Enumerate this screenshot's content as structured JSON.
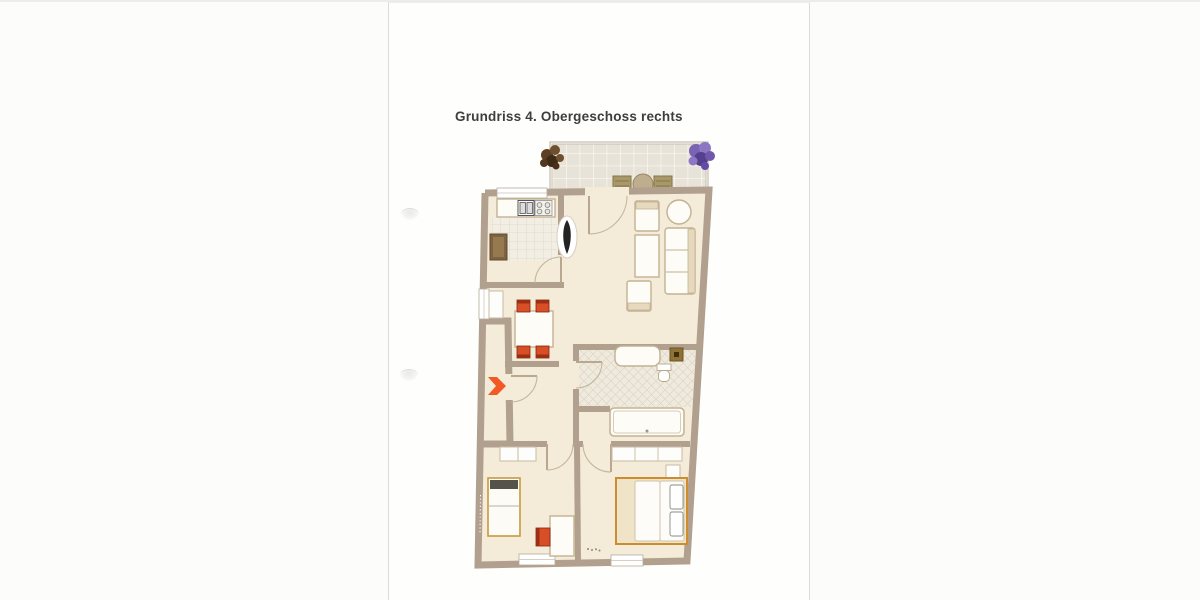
{
  "page": {
    "title": "Grundriss 4. Obergeschoss rechts"
  },
  "floorplan": {
    "floor_label": "4. Obergeschoss",
    "side_label": "rechts",
    "rooms": [
      "Balkon",
      "Küche",
      "Wohnen/Essen",
      "Diele",
      "Bad",
      "Zimmer",
      "Schlafzimmer"
    ],
    "icons": [
      "plant-icon",
      "terrace-chair-icon",
      "terrace-table-icon",
      "sink-icon",
      "stove-icon",
      "fridge-cabinet-icon",
      "decor-plant-icon",
      "dining-table-icon",
      "dining-chair-icon",
      "entrance-arrow-icon",
      "vanity-icon",
      "toilet-icon",
      "shaft-icon",
      "bathtub-icon",
      "single-bed-icon",
      "desk-icon",
      "desk-chair-icon",
      "wardrobe-icon",
      "double-bed-icon",
      "nightstand-icon",
      "doormat-icon",
      "armchair-icon",
      "coffee-table-icon",
      "sofa-icon",
      "side-table-icon",
      "window-icon",
      "door-arc-icon"
    ]
  },
  "colors": {
    "wall": "#b2a08e",
    "floor": "#f4ebd9",
    "balcony-tile": "#e8e3d8",
    "kitchen-tile": "#f2eee3",
    "bath-tile": "#efeadd",
    "furniture-stroke": "#c3b193",
    "furniture-fill": "#fdfcf7",
    "chair-red": "#d84f27",
    "chair-red-dark": "#9c2f12",
    "bed-frame": "#cd8c2e",
    "bed-frame-fill": "#efe3c8",
    "entrance-arrow": "#f15a24",
    "plant-brown": "#5d4024",
    "plant-purple": "#7a63b5",
    "door-arc": "#c5b69c",
    "title-text": "#3f3e3b"
  }
}
